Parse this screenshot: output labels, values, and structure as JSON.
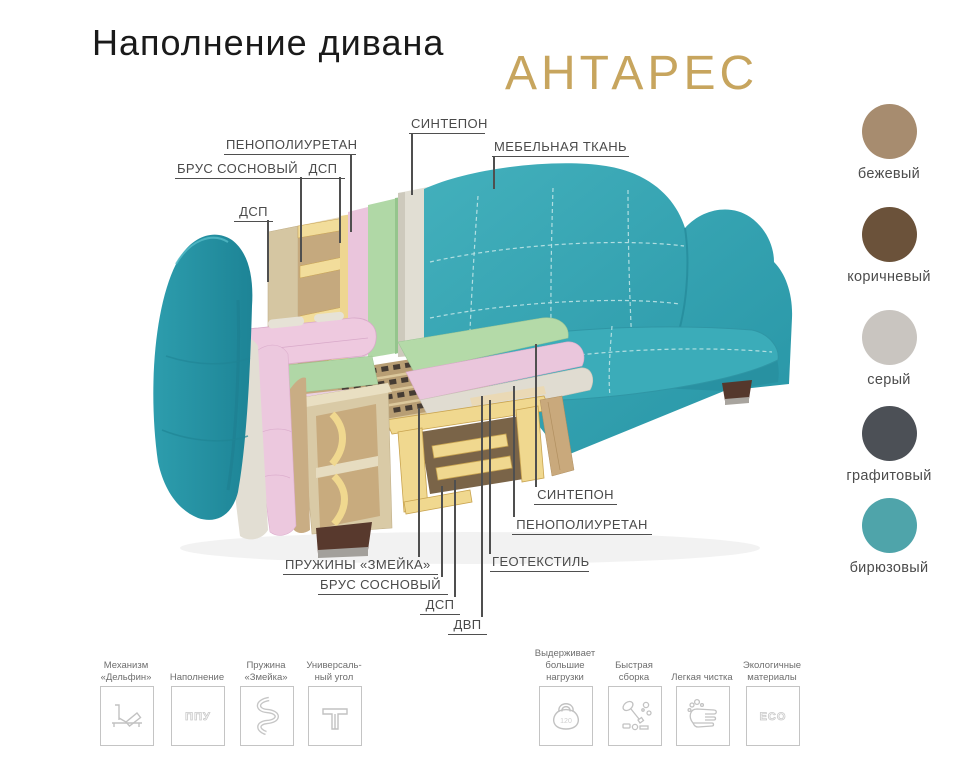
{
  "title": "Наполнение дивана",
  "product_name": "АНТАРЕС",
  "colors": {
    "accent_gold": "#c7a55e",
    "label_gray": "#4a4a4a",
    "sofa_teal": "#2fa4b4"
  },
  "diagram": {
    "labels": [
      {
        "id": "sintepon-top",
        "text": "СИНТЕПОН"
      },
      {
        "id": "mebelnaya-tkan",
        "text": "МЕБЕЛЬНАЯ ТКАНЬ"
      },
      {
        "id": "penopoliuretan-top",
        "text": "ПЕНОПОЛИУРЕТАН"
      },
      {
        "id": "brus-sosnovy-top",
        "text": "БРУС СОСНОВЫЙ"
      },
      {
        "id": "dsp-top",
        "text": "ДСП"
      },
      {
        "id": "dsp-left",
        "text": "ДСП"
      },
      {
        "id": "pruzhiny-zmeika",
        "text": "ПРУЖИНЫ «ЗМЕЙКА»"
      },
      {
        "id": "brus-sosnovy-bottom",
        "text": "БРУС СОСНОВЫЙ"
      },
      {
        "id": "dsp-bottom",
        "text": "ДСП"
      },
      {
        "id": "dvp",
        "text": "ДВП"
      },
      {
        "id": "geotekstil",
        "text": "ГЕОТЕКСТИЛЬ"
      },
      {
        "id": "penopoliuretan-right",
        "text": "ПЕНОПОЛИУРЕТАН"
      },
      {
        "id": "sintepon-right",
        "text": "СИНТЕПОН"
      }
    ]
  },
  "swatches": [
    {
      "name": "бежевый",
      "hex": "#a78c6f"
    },
    {
      "name": "коричневый",
      "hex": "#6b523a"
    },
    {
      "name": "серый",
      "hex": "#c9c5c0"
    },
    {
      "name": "графитовый",
      "hex": "#4c5056"
    },
    {
      "name": "бирюзовый",
      "hex": "#4fa4aa"
    }
  ],
  "features": [
    {
      "icon": "sofa-bed-mechanism",
      "label": "Механизм\n«Дельфин»"
    },
    {
      "icon": "ppu-filling",
      "label": "Наполнение",
      "icon_text": "ППУ"
    },
    {
      "icon": "snake-spring",
      "label": "Пружина\n«Змейка»"
    },
    {
      "icon": "universal-corner",
      "label": "Универсаль-\nный угол"
    },
    {
      "icon": "kettlebell",
      "label": "Выдерживает\nбольшие\nнагрузки",
      "icon_text": "120"
    },
    {
      "icon": "quick-assembly",
      "label": "Быстрая\nсборка"
    },
    {
      "icon": "easy-cleaning",
      "label": "Легкая чистка"
    },
    {
      "icon": "eco-materials",
      "label": "Экологичные\nматериалы",
      "icon_text": "ECO"
    }
  ]
}
